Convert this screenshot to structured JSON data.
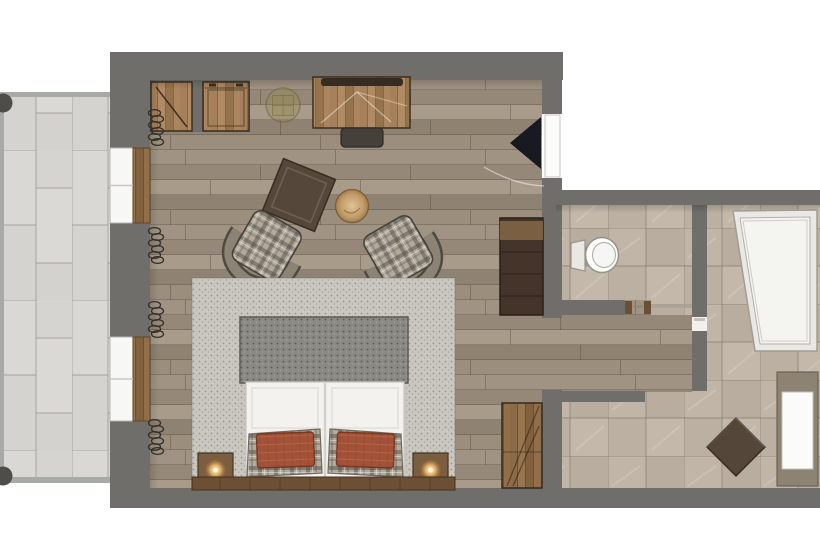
{
  "scene": {
    "kind": "architectural floor plan, top-down rendered view, no visible text"
  },
  "palette": {
    "exterior": "#ffffff",
    "wall": "#6f6e6b",
    "wood_floor": "#9a8d7c",
    "balcony_tile": "#d7d5d1",
    "balcony_rail": "#a8aaa8",
    "bath_tile": "#bcb1a3",
    "rug_speckle": "#cac6c0",
    "bed_blanket": "#8e8b86",
    "bed_duvet": "#f3f2ef",
    "pillow_rust": "#a3523a",
    "plaid_upholstery": "#b2aa9c",
    "furniture_wood": "#8a6a46",
    "dark_dresser": "#44342a",
    "door_leaf_open": "#171a20",
    "lamp_glow": "#f0c989",
    "sanitary_white": "#f4f4f1"
  },
  "labels": {
    "floorplan": "hotel room floor plan",
    "balcony": "balcony with stone tiles and railing",
    "bedroom": "bedroom with wood plank floor",
    "bathroom": "bathroom with tiled floor",
    "bed": "double bed with white duvet",
    "blanket": "gray bed runner at foot of bed",
    "rug": "large textured area rug under bed",
    "pillow_left": "rust plaid pillow left",
    "pillow_right": "rust plaid pillow right",
    "headboard": "wooden headboard",
    "nightstand_left": "left nightstand with lit lamp",
    "nightstand_right": "right nightstand with lit lamp",
    "armchair_left": "plaid tub armchair left",
    "armchair_right": "plaid tub armchair right",
    "side_table": "round wooden side table",
    "ottoman": "square upholstered ottoman",
    "desk": "wooden desk against top wall",
    "desk_stool": "desk bench",
    "wardrobe": "built-in wardrobe niche with door swing",
    "cabinet": "built-in cabinet niche",
    "ceiling_light": "ceiling light medallion",
    "dresser": "dark dresser / minibar unit",
    "tall_cabinet": "wooden shelf cabinet",
    "entry_door": "entry door open into room",
    "window_top": "upper balcony window",
    "window_bottom": "lower balcony window",
    "curtains": "curtain coil symbols",
    "toilet": "toilet",
    "shower": "walk-in shower tray",
    "vanity": "washbasin vanity unit",
    "diamond_stool": "rotated square stool in hallway",
    "wc_door": "wc door opening",
    "railing_post": "balcony railing post"
  }
}
